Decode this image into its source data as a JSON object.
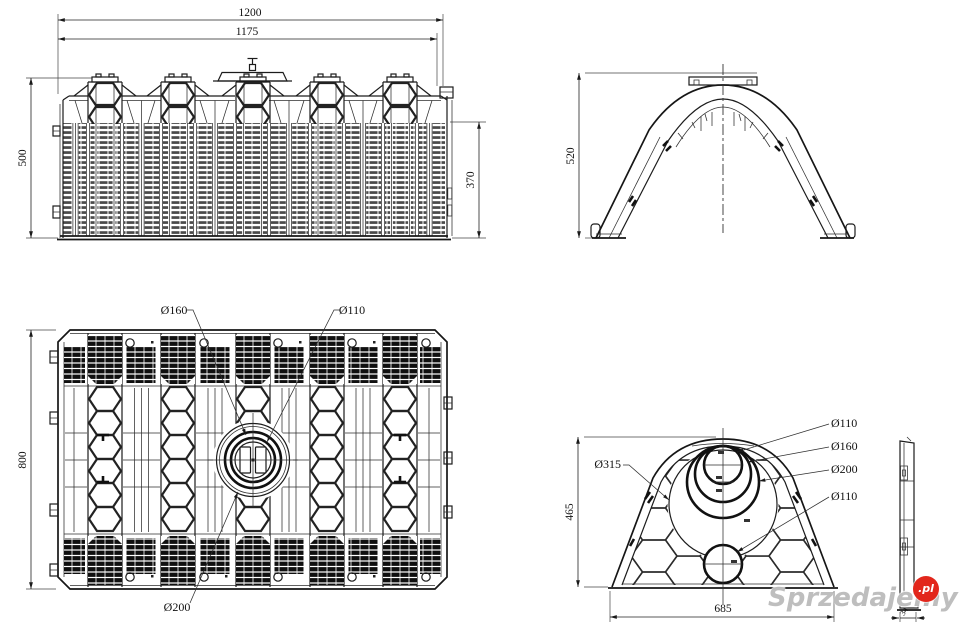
{
  "views": {
    "front_elevation": {
      "dim_overall_width": "1200",
      "dim_inner_width": "1175",
      "dim_height": "500",
      "dim_body_height": "370"
    },
    "cross_section": {
      "dim_height": "520"
    },
    "plan": {
      "dim_depth": "800",
      "label_port_160": "Ø160",
      "label_port_110": "Ø110",
      "label_port_200": "Ø200"
    },
    "end_view": {
      "dim_height": "465",
      "dim_width": "685",
      "label_port_315": "Ø315",
      "label_port_110_top": "Ø110",
      "label_port_160": "Ø160",
      "label_port_200": "Ø200",
      "label_port_110_bottom": "Ø110"
    },
    "side_profile": {
      "dim_thickness": "34"
    },
    "line_color": "#1c1c1c"
  },
  "watermark": {
    "text": "Sprzedajemy",
    "suffix": ".pl",
    "badge_color": "#e2271c"
  }
}
